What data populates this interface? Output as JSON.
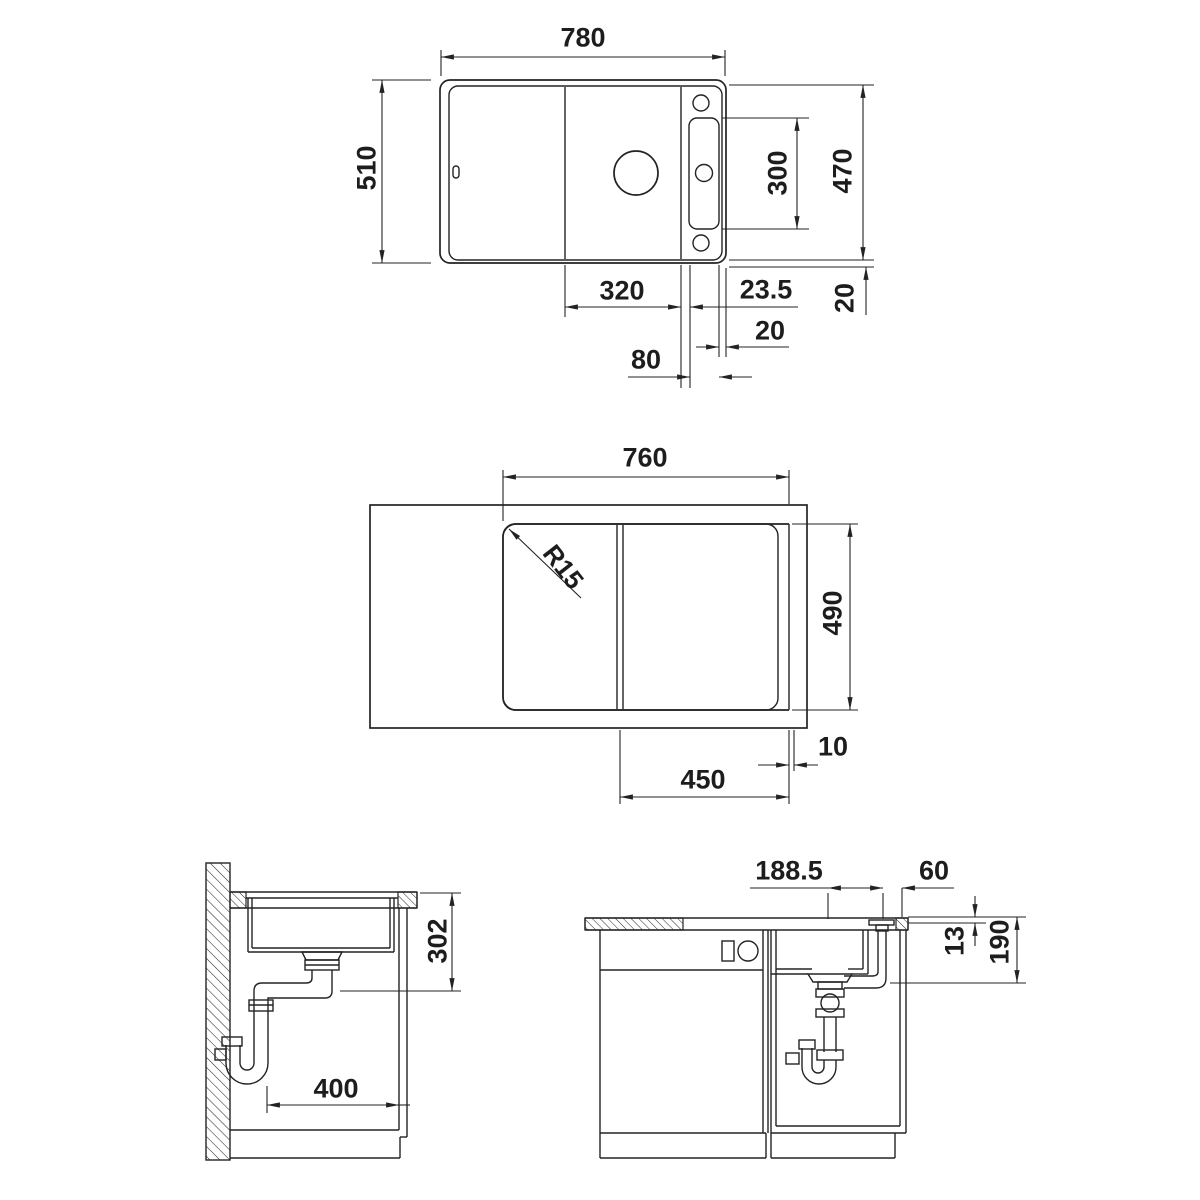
{
  "drawing": {
    "background": "#ffffff",
    "line_color": "#232323",
    "views": {
      "top_view": {
        "overall_width": "780",
        "overall_depth": "510",
        "inner_depth": "470",
        "tap_panel_height": "300",
        "bowl_width": "320",
        "bowl_to_panel": "23.5",
        "panel_to_edge": "20",
        "panel_width": "80",
        "rim_width": "20"
      },
      "underside_view": {
        "cutout_width": "760",
        "corner_radius": "R15",
        "cutout_depth": "490",
        "edge_gap": "10",
        "board_width": "450"
      },
      "side_section": {
        "installation_depth": "302",
        "drain_offset": "400"
      },
      "front_section": {
        "drain_to_control": "188.5",
        "control_to_edge": "60",
        "flush_depth": "13",
        "outlet_depth": "190"
      }
    }
  }
}
